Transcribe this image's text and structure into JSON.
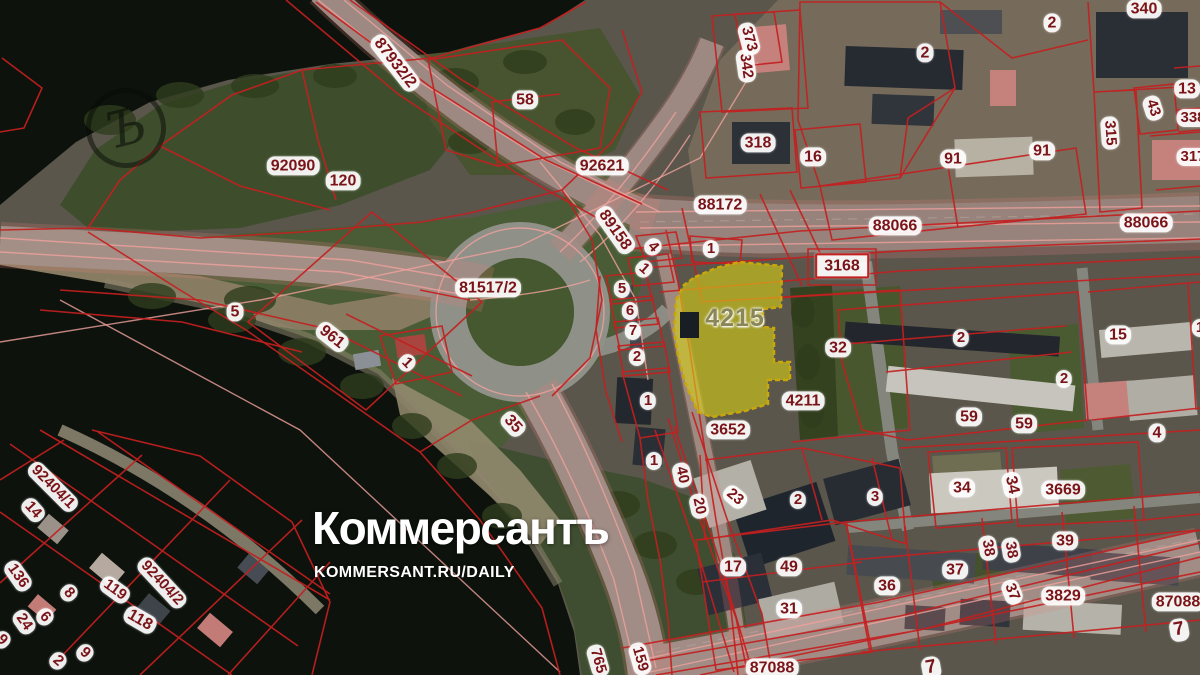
{
  "branding": {
    "logo": "Коммерсантъ",
    "site": "KOMMERSANT.RU/DAILY",
    "monogram": "Ъ"
  },
  "map": {
    "type": "cadastral-satellite-overlay",
    "highlighted_parcel": "4215",
    "colors": {
      "cadastral_line": "#c32020",
      "overlay_pink": "#f0a19c",
      "label_text": "#7a1418",
      "label_bg": "rgba(255,255,255,0.93)",
      "highlight_fill": "#d9d216",
      "highlight_stroke": "#c9a70a",
      "highlight_label": "#8b8657",
      "water": "#0d120c"
    },
    "labels": [
      {
        "t": "87932/2",
        "x": 395,
        "y": 63,
        "r": 52,
        "fs": 16
      },
      {
        "t": "58",
        "x": 525,
        "y": 100,
        "fs": 16
      },
      {
        "t": "92090",
        "x": 293,
        "y": 166,
        "fs": 16
      },
      {
        "t": "120",
        "x": 343,
        "y": 181,
        "fs": 16
      },
      {
        "t": "92621",
        "x": 602,
        "y": 166,
        "fs": 16
      },
      {
        "t": "342",
        "x": 746,
        "y": 66,
        "r": 82
      },
      {
        "t": "373",
        "x": 749,
        "y": 39,
        "r": 75
      },
      {
        "t": "318",
        "x": 758,
        "y": 143,
        "fs": 16
      },
      {
        "t": "16",
        "x": 813,
        "y": 157,
        "fs": 16
      },
      {
        "t": "2",
        "x": 925,
        "y": 53,
        "fs": 16
      },
      {
        "t": "2",
        "x": 1052,
        "y": 23,
        "fs": 16
      },
      {
        "t": "340",
        "x": 1144,
        "y": 9,
        "fs": 16
      },
      {
        "t": "13",
        "x": 1187,
        "y": 89,
        "fs": 16
      },
      {
        "t": "43",
        "x": 1153,
        "y": 108,
        "r": 72
      },
      {
        "t": "338",
        "x": 1193,
        "y": 118
      },
      {
        "t": "315",
        "x": 1110,
        "y": 133,
        "r": 86
      },
      {
        "t": "317",
        "x": 1193,
        "y": 157
      },
      {
        "t": "91",
        "x": 953,
        "y": 159,
        "fs": 16
      },
      {
        "t": "91",
        "x": 1042,
        "y": 151,
        "fs": 16
      },
      {
        "t": "88066",
        "x": 895,
        "y": 226,
        "fs": 16
      },
      {
        "t": "88066",
        "x": 1146,
        "y": 223,
        "fs": 16
      },
      {
        "t": "88172",
        "x": 720,
        "y": 205,
        "fs": 16
      },
      {
        "t": "89158",
        "x": 615,
        "y": 230,
        "r": 55,
        "fs": 16
      },
      {
        "t": "4",
        "x": 653,
        "y": 247,
        "r": 48
      },
      {
        "t": "1",
        "x": 644,
        "y": 269,
        "r": 42
      },
      {
        "t": "1",
        "x": 711,
        "y": 249
      },
      {
        "t": "3168",
        "x": 842,
        "y": 266,
        "v": "boxed",
        "fs": 16
      },
      {
        "t": "81517/2",
        "x": 488,
        "y": 288,
        "fs": 16
      },
      {
        "t": "5",
        "x": 622,
        "y": 289
      },
      {
        "t": "6",
        "x": 630,
        "y": 311
      },
      {
        "t": "7",
        "x": 633,
        "y": 331
      },
      {
        "t": "2",
        "x": 637,
        "y": 357
      },
      {
        "t": "4215",
        "x": 735,
        "y": 318,
        "v": "hl"
      },
      {
        "t": "32",
        "x": 838,
        "y": 348,
        "fs": 16
      },
      {
        "t": "2",
        "x": 961,
        "y": 338
      },
      {
        "t": "15",
        "x": 1118,
        "y": 335,
        "fs": 16
      },
      {
        "t": "1",
        "x": 1200,
        "y": 328
      },
      {
        "t": "2",
        "x": 1064,
        "y": 379
      },
      {
        "t": "4211",
        "x": 803,
        "y": 401,
        "fs": 16
      },
      {
        "t": "1",
        "x": 648,
        "y": 401
      },
      {
        "t": "3652",
        "x": 728,
        "y": 430,
        "fs": 16
      },
      {
        "t": "59",
        "x": 969,
        "y": 417,
        "fs": 16
      },
      {
        "t": "59",
        "x": 1024,
        "y": 424,
        "fs": 16
      },
      {
        "t": "4",
        "x": 1157,
        "y": 433,
        "fs": 16
      },
      {
        "t": "5",
        "x": 235,
        "y": 312,
        "fs": 16
      },
      {
        "t": "961",
        "x": 332,
        "y": 337,
        "r": 38,
        "fs": 16
      },
      {
        "t": "1",
        "x": 407,
        "y": 363,
        "r": 45
      },
      {
        "t": "35",
        "x": 513,
        "y": 424,
        "r": 48,
        "fs": 16
      },
      {
        "t": "1",
        "x": 654,
        "y": 461
      },
      {
        "t": "40",
        "x": 682,
        "y": 475,
        "r": 78
      },
      {
        "t": "20",
        "x": 699,
        "y": 506,
        "r": 78
      },
      {
        "t": "23",
        "x": 735,
        "y": 497,
        "r": 40
      },
      {
        "t": "2",
        "x": 798,
        "y": 500
      },
      {
        "t": "3",
        "x": 875,
        "y": 497
      },
      {
        "t": "34",
        "x": 962,
        "y": 488,
        "fs": 16
      },
      {
        "t": "34",
        "x": 1012,
        "y": 485,
        "r": 78,
        "fs": 16
      },
      {
        "t": "3669",
        "x": 1063,
        "y": 490,
        "fs": 16
      },
      {
        "t": "17",
        "x": 733,
        "y": 567,
        "fs": 16
      },
      {
        "t": "49",
        "x": 789,
        "y": 567,
        "fs": 16
      },
      {
        "t": "38",
        "x": 988,
        "y": 548,
        "r": 80
      },
      {
        "t": "38",
        "x": 1011,
        "y": 550,
        "r": 80
      },
      {
        "t": "39",
        "x": 1065,
        "y": 541,
        "fs": 16
      },
      {
        "t": "37",
        "x": 955,
        "y": 570,
        "fs": 16
      },
      {
        "t": "36",
        "x": 887,
        "y": 586,
        "fs": 16
      },
      {
        "t": "31",
        "x": 789,
        "y": 609,
        "fs": 16
      },
      {
        "t": "37",
        "x": 1012,
        "y": 592,
        "r": 68
      },
      {
        "t": "3829",
        "x": 1063,
        "y": 596,
        "fs": 16
      },
      {
        "t": "87088",
        "x": 1178,
        "y": 602,
        "fs": 16
      },
      {
        "t": "7",
        "x": 1179,
        "y": 630,
        "r": -10,
        "fs": 19
      },
      {
        "t": "87088",
        "x": 772,
        "y": 668,
        "fs": 16
      },
      {
        "t": "7",
        "x": 931,
        "y": 668,
        "r": -10,
        "fs": 19
      },
      {
        "t": "92404/1",
        "x": 53,
        "y": 487,
        "r": 45
      },
      {
        "t": "14",
        "x": 33,
        "y": 510,
        "r": 48
      },
      {
        "t": "136",
        "x": 18,
        "y": 576,
        "r": 55
      },
      {
        "t": "8",
        "x": 69,
        "y": 593,
        "r": 48
      },
      {
        "t": "119",
        "x": 115,
        "y": 590,
        "r": 36
      },
      {
        "t": "92404/2",
        "x": 162,
        "y": 583,
        "r": 47
      },
      {
        "t": "24",
        "x": 24,
        "y": 622,
        "r": 55
      },
      {
        "t": "6",
        "x": 45,
        "y": 617,
        "r": 48
      },
      {
        "t": "118",
        "x": 140,
        "y": 620,
        "r": 30,
        "fs": 16
      },
      {
        "t": "9",
        "x": 2,
        "y": 640,
        "r": 45
      },
      {
        "t": "9",
        "x": 85,
        "y": 653,
        "r": 42
      },
      {
        "t": "2",
        "x": 58,
        "y": 661,
        "r": 42
      },
      {
        "t": "765",
        "x": 598,
        "y": 661,
        "r": 74
      },
      {
        "t": "159",
        "x": 640,
        "y": 659,
        "r": 74
      }
    ]
  }
}
